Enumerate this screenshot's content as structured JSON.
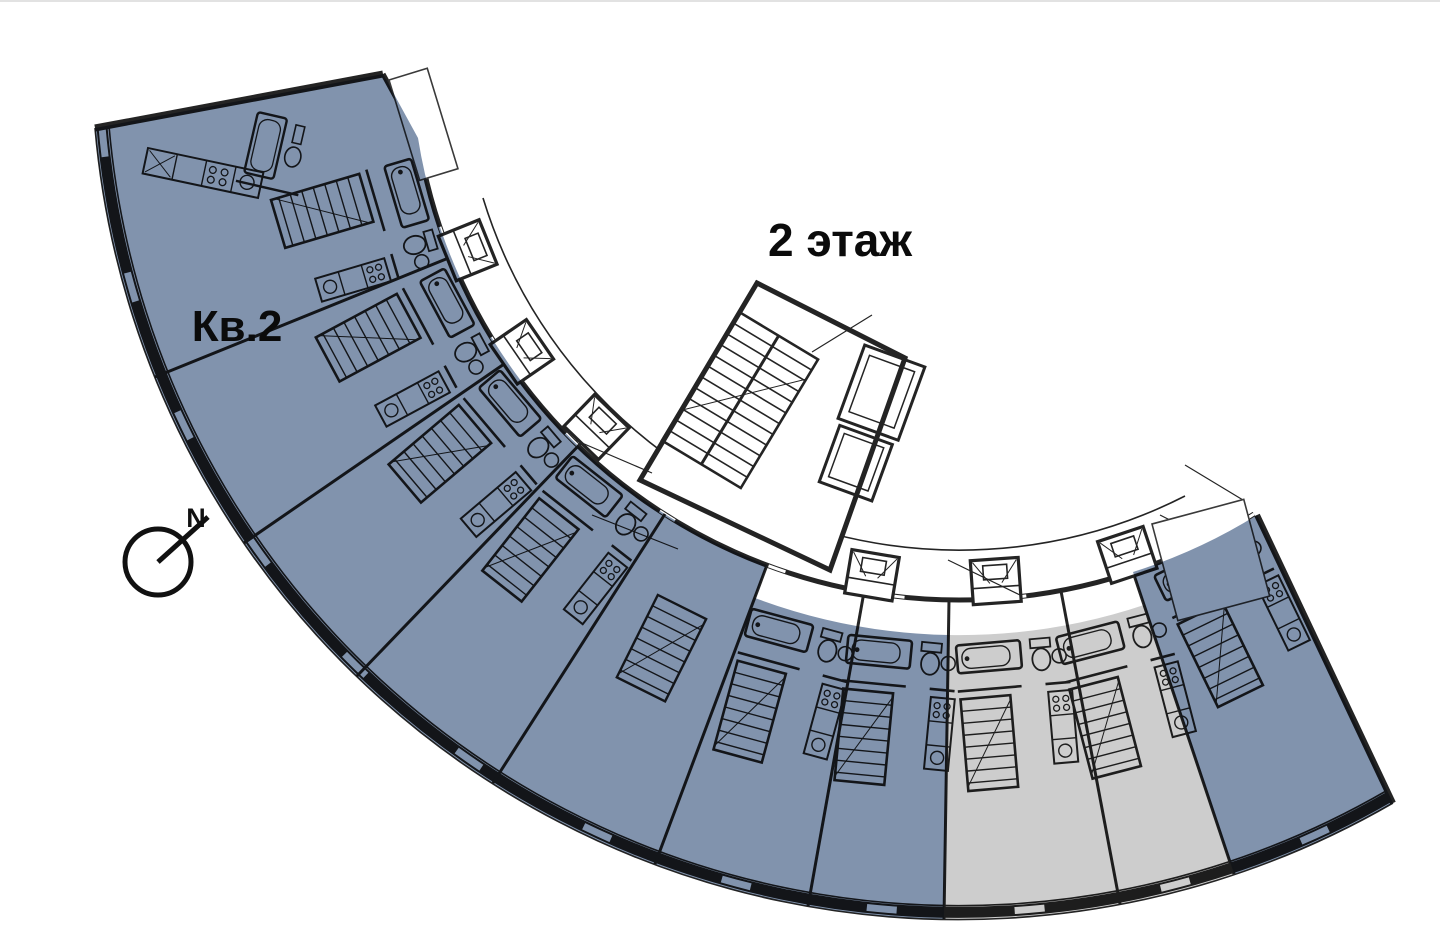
{
  "plan": {
    "floor_label": "2 этаж",
    "apartment_label": "Кв.2",
    "compass_letter": "N",
    "colors": {
      "highlight_blue": "#8193ad",
      "highlight_gray": "#cdcdcd",
      "linework": "#242424",
      "background": "#ffffff"
    }
  }
}
